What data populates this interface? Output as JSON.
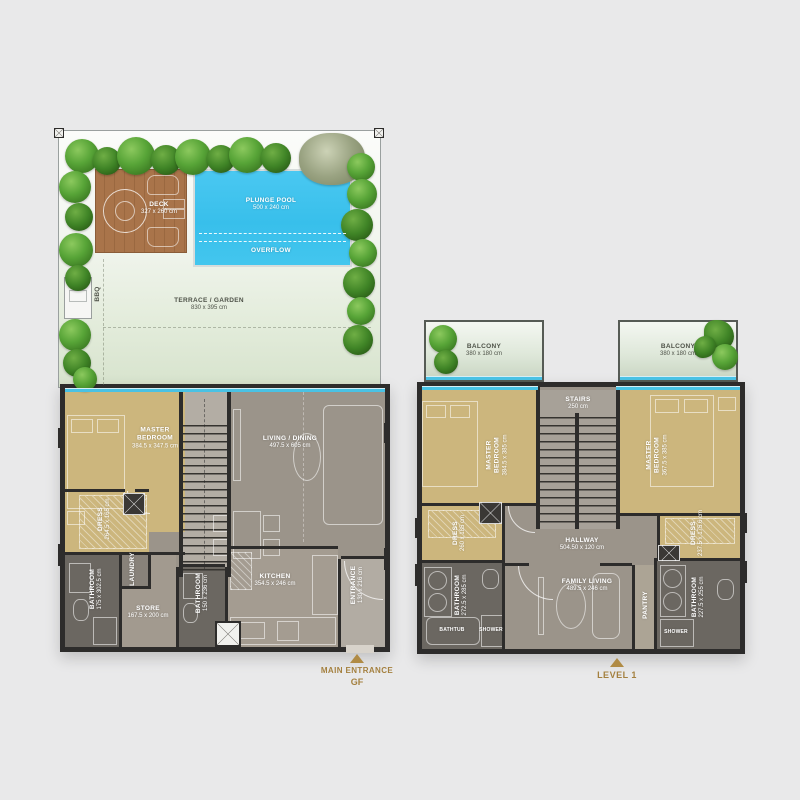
{
  "plan_gf": {
    "outdoor": {
      "deck": {
        "name": "DECK",
        "dims": "327 x 260 cm"
      },
      "plunge_pool": {
        "name": "PLUNGE POOL",
        "dims": "500 x 240 cm"
      },
      "overflow": {
        "name": "OVERFLOW"
      },
      "bbq": {
        "name": "BBQ"
      },
      "terrace": {
        "name": "TERRACE / GARDEN",
        "dims": "830 x 395 cm"
      }
    },
    "rooms": {
      "master_bedroom": {
        "name": "MASTER BEDROOM",
        "dims": "384.5 x 347.5 cm"
      },
      "living_dining": {
        "name": "LIVING / DINING",
        "dims": "497.5 x 605 cm"
      },
      "dress": {
        "name": "DRESS",
        "dims": "264.5 x 165 cm"
      },
      "laundry": {
        "name": "LAUNDRY"
      },
      "bathroom_1": {
        "name": "BATHROOM",
        "dims": "175 x 302.5 cm"
      },
      "store": {
        "name": "STORE",
        "dims": "167.5 x 200 cm"
      },
      "bathroom_2": {
        "name": "BATHROOM",
        "dims": "150 x 236 cm"
      },
      "kitchen": {
        "name": "KITCHEN",
        "dims": "354.5 x 246 cm"
      },
      "entrance": {
        "name": "ENTRANCE",
        "dims": "130 x 216 cm"
      }
    },
    "marker": {
      "line1": "MAIN ENTRANCE",
      "line2": "GF"
    }
  },
  "plan_level1": {
    "rooms": {
      "balcony_left": {
        "name": "BALCONY",
        "dims": "380 x 180 cm"
      },
      "balcony_right": {
        "name": "BALCONY",
        "dims": "380 x 180 cm"
      },
      "stairs": {
        "name": "STAIRS",
        "dims": "250 cm"
      },
      "master_bedroom_left": {
        "name": "MASTER BEDROOM",
        "dims": "384.5 x 385 cm"
      },
      "master_bedroom_right": {
        "name": "MASTER BEDROOM",
        "dims": "367.5 x 385 cm"
      },
      "dress_left": {
        "name": "DRESS",
        "dims": "260 x 185 cm"
      },
      "dress_right": {
        "name": "DRESS",
        "dims": "237.5 x 175.6 cm"
      },
      "bathroom_left": {
        "name": "BATHROOM",
        "dims": "272.5 x 285 cm"
      },
      "bathroom_right": {
        "name": "BATHROOM",
        "dims": "227.5 x 255 cm"
      },
      "bathtub": {
        "name": "BATHTUB"
      },
      "shower_left": {
        "name": "SHOWER"
      },
      "shower_right": {
        "name": "SHOWER"
      },
      "hallway": {
        "name": "HALLWAY",
        "dims": "504.50 x 120 cm"
      },
      "family_living": {
        "name": "FAMILY LIVING",
        "dims": "489.5 x 246 cm"
      },
      "pantry": {
        "name": "PANTRY"
      }
    },
    "marker": {
      "line1": "LEVEL 1"
    }
  },
  "colors": {
    "background": "#e9e9ea",
    "wall_dark": "#2d2c2b",
    "pool_blue": "#3fc0ec",
    "deck_wood": "#a9744a",
    "bedroom_tan": "#ccb67d",
    "living_gray": "#9b948a",
    "bathroom_gray": "#6b6761",
    "hedge_green": "#55a035",
    "glass_cyan": "#49c2e4",
    "accent_gold": "#a4803f"
  }
}
